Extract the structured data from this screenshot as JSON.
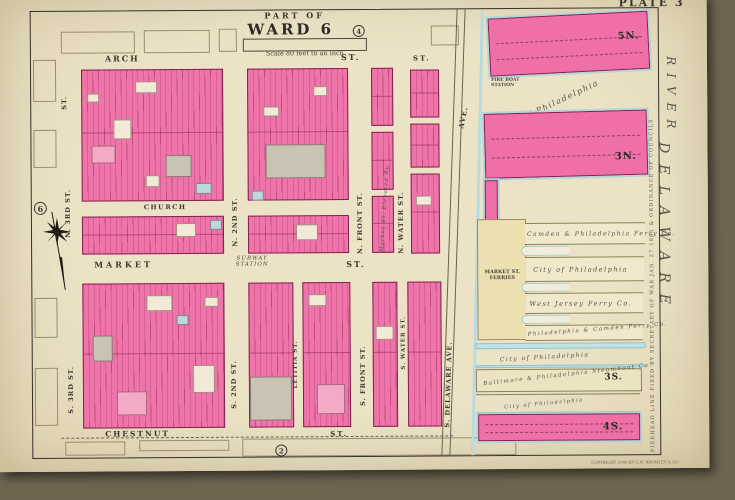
{
  "plate_label": "PLATE 3",
  "title_block": {
    "part_of": "PART OF",
    "ward": "WARD 6",
    "ward_circle": "4",
    "scale": "Scale 80 feet to an inch"
  },
  "margin": {
    "circle_left": "6",
    "circle_bottom": "2",
    "copyright": "COPYRIGHT 1908 BY G.W. BROMLEY & CO."
  },
  "streets": {
    "arch": "ARCH",
    "arch_st": "ST.",
    "arch_st2": "ST.",
    "st_vert": "ST.",
    "church": "CHURCH",
    "market": "MARKET",
    "market_st": "ST.",
    "subway": "SUBWAY",
    "station": "STATION",
    "chestnut": "CHESTNUT",
    "chestnut_st": "ST.",
    "n3rd": "N. 3RD ST.",
    "s3rd": "S. 3RD ST.",
    "n2nd": "N. 2ND ST.",
    "s2nd": "S. 2ND ST.",
    "letitia": "LETITIA ST.",
    "nfront": "N. FRONT ST.",
    "sfront": "S. FRONT ST.",
    "nwater": "N. WATER ST.",
    "swater": "S. WATER ST.",
    "del_ave": "AVE.",
    "s_del_ave": "S. DELAWARE AVE.",
    "elevated": "Market St. Elevated Ry."
  },
  "river": {
    "name": "DELAWARE",
    "name2": "RIVER",
    "pierhead": "PIERHEAD LINE FIXED BY SECRETARY OF WAR JAN. 27 1891 & ORDINANCE OF COUNCILS"
  },
  "piers": {
    "five_n": "5N.",
    "three_n": "3N.",
    "three_s": "3S.",
    "four_s": "4S.",
    "station": "FIRE BOAT STATION",
    "city1": "City of Philadelphia",
    "camden": "Camden & Philadelphia Ferry Co.",
    "city2": "City of Philadelphia",
    "west_jersey": "West Jersey Ferry Co.",
    "phila_camden": "Philadelphia & Camden Ferry Co.",
    "city3": "City of Philadelphia",
    "baltimore": "Baltimore & Philadelphia Steamboat Co.",
    "city4": "City of Philadelphia",
    "ferries": "MARKET ST. FERRIES"
  },
  "colors": {
    "building_pink": "#ee74a9",
    "pier_pink": "#ef6fa7",
    "water_blue": "#c2e1e5",
    "pier_cream": "#ece4c0",
    "page_cream": "#e9dfc2"
  }
}
